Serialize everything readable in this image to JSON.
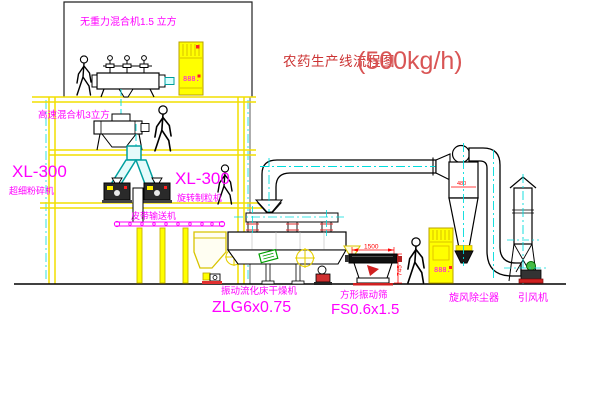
{
  "title": {
    "name": "农药生产线流程图",
    "capacity": "(500kg/h)"
  },
  "labels": {
    "gravity_mixer": "无重力混合机1.5 立方",
    "high_speed_mixer": "高速混合机3立方",
    "mill_model": "XL-300",
    "mill_name": "超细粉碎机",
    "granulator_model": "XL-300",
    "granulator_name": "旋转制粒机",
    "belt": "皮带输送机",
    "dryer_name": "振动流化床干燥机",
    "dryer_model": "ZLG6x0.75",
    "sieve_name": "方形振动筛",
    "sieve_model": "FS0.6x1.5",
    "cyclone": "旋风除尘器",
    "fan": "引风机"
  },
  "dimensions": {
    "sieve_length": "1500",
    "sieve_height": "745",
    "cyclone_width": "480"
  },
  "displays": {
    "cabinet1": "888.",
    "cabinet2": "888."
  },
  "colors": {
    "structure_yellow": "#f2df00",
    "label_magenta": "#ff00ff",
    "title_red": "#cc3333",
    "dimension_red": "#ff0000",
    "centerline_cyan": "#00dcdc",
    "chute_teal": "#009f9f"
  }
}
